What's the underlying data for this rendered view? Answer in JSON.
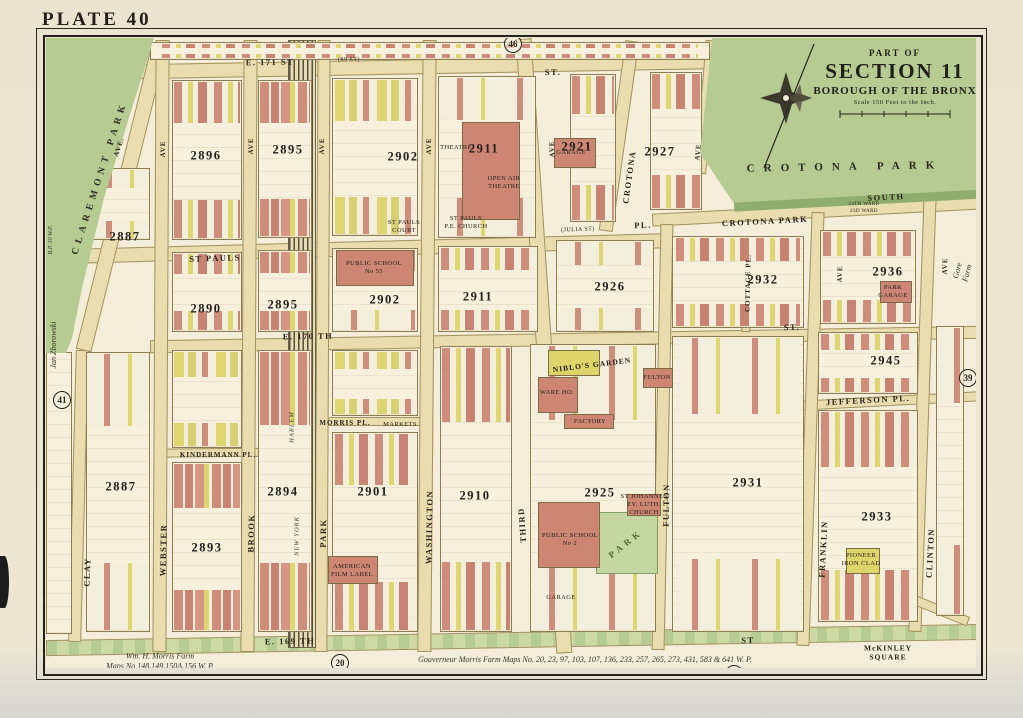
{
  "plate": "PLATE 40",
  "title_block": {
    "part_of": "PART OF",
    "section": "SECTION 11",
    "borough": "BOROUGH OF THE BRONX",
    "scale": "Scale 150 Feet to the Inch."
  },
  "colors": {
    "paper": "#e9e3cf",
    "map_bg": "#f3edda",
    "road": "#e9ddb0",
    "park_green": "#b5cb92",
    "park_edge": "#8fae6e",
    "building_pink": "#cd8574",
    "building_yellow": "#ddd46a",
    "railroad": "#57503c",
    "ink": "#25211a"
  },
  "map": {
    "roads": [
      {
        "id": "e-171-st",
        "x": 46,
        "y": 60,
        "w": 668,
        "h": 15,
        "rot": -1
      },
      {
        "id": "st-pauls-pl",
        "x": 76,
        "y": 241,
        "w": 588,
        "h": 15,
        "rot": -1.5
      },
      {
        "id": "crotona-park-south",
        "x": 652,
        "y": 205,
        "w": 332,
        "h": 13,
        "rot": -3
      },
      {
        "id": "e-170-st",
        "x": 150,
        "y": 333,
        "w": 834,
        "h": 13,
        "rot": -1
      },
      {
        "id": "kindermann-pl",
        "x": 162,
        "y": 448,
        "w": 142,
        "h": 9,
        "rot": -0.5
      },
      {
        "id": "morris-pl",
        "x": 328,
        "y": 417,
        "w": 94,
        "h": 9,
        "rot": 0
      },
      {
        "id": "jefferson-pl",
        "x": 793,
        "y": 396,
        "w": 192,
        "h": 10,
        "rot": -3
      },
      {
        "id": "e-169-st",
        "x": 46,
        "y": 632,
        "w": 938,
        "h": 16,
        "rot": -1,
        "cls": "green"
      },
      {
        "id": "claremont-pkwy",
        "x": 113,
        "y": 45,
        "w": 16,
        "h": 310,
        "rot": 14
      },
      {
        "id": "clay-ave",
        "x": 72,
        "y": 350,
        "w": 13,
        "h": 292,
        "rot": 1.5
      },
      {
        "id": "webster-ave",
        "x": 154,
        "y": 40,
        "w": 14,
        "h": 612,
        "rot": 0.3
      },
      {
        "id": "brook-ave",
        "x": 242,
        "y": 40,
        "w": 14,
        "h": 612,
        "rot": 0.3
      },
      {
        "id": "park-ave",
        "x": 316,
        "y": 40,
        "w": 13,
        "h": 612,
        "rot": 0.3
      },
      {
        "id": "washington-ave",
        "x": 420,
        "y": 40,
        "w": 14,
        "h": 612,
        "rot": 0.5
      },
      {
        "id": "third-ave",
        "x": 536,
        "y": 38,
        "w": 16,
        "h": 616,
        "rot": -3.8
      },
      {
        "id": "crotona-ave",
        "x": 612,
        "y": 40,
        "w": 14,
        "h": 192,
        "rot": 8
      },
      {
        "id": "crotona-ave-park-edge",
        "x": 700,
        "y": 40,
        "w": 12,
        "h": 134,
        "rot": 5
      },
      {
        "id": "fulton-ave",
        "x": 656,
        "y": 224,
        "w": 13,
        "h": 426,
        "rot": 1.2
      },
      {
        "id": "franklin-ave",
        "x": 804,
        "y": 212,
        "w": 13,
        "h": 434,
        "rot": 2
      },
      {
        "id": "clinton-ave",
        "x": 916,
        "y": 196,
        "w": 13,
        "h": 436,
        "rot": 2
      },
      {
        "id": "cottage-pl",
        "x": 742,
        "y": 244,
        "w": 9,
        "h": 88,
        "rot": 1
      },
      {
        "id": "mckinley-sq-diagonal",
        "x": 872,
        "y": 598,
        "w": 100,
        "h": 10,
        "rot": 22
      }
    ],
    "railroad_band": {
      "id": "ny-harlem-rr",
      "x": 288,
      "y": 40,
      "w": 28,
      "h": 608
    },
    "blocks": [
      {
        "id": "north-strip",
        "x": 150,
        "y": 42,
        "w": 560,
        "h": 18,
        "v": "v-mixed"
      },
      {
        "id": "2896-n",
        "x": 172,
        "y": 80,
        "w": 70,
        "h": 160,
        "v": "v-mixed"
      },
      {
        "id": "2895-n",
        "x": 258,
        "y": 80,
        "w": 54,
        "h": 158,
        "v": "v-dense"
      },
      {
        "id": "2902-n",
        "x": 332,
        "y": 78,
        "w": 86,
        "h": 158,
        "v": "v-yellow"
      },
      {
        "id": "2911-n",
        "x": 438,
        "y": 76,
        "w": 98,
        "h": 162,
        "v": "v-sparse"
      },
      {
        "id": "2921",
        "x": 570,
        "y": 74,
        "w": 46,
        "h": 148,
        "v": "v-mixed"
      },
      {
        "id": "2927",
        "x": 650,
        "y": 72,
        "w": 52,
        "h": 138,
        "v": "v-mixed"
      },
      {
        "id": "2890",
        "x": 172,
        "y": 252,
        "w": 70,
        "h": 80,
        "v": "v-mixed"
      },
      {
        "id": "2895-s",
        "x": 258,
        "y": 250,
        "w": 54,
        "h": 82,
        "v": "v-dense"
      },
      {
        "id": "2902-s",
        "x": 332,
        "y": 248,
        "w": 86,
        "h": 84,
        "v": "v-sparse"
      },
      {
        "id": "2911-s",
        "x": 438,
        "y": 246,
        "w": 100,
        "h": 86,
        "v": "v-mixed"
      },
      {
        "id": "2926",
        "x": 556,
        "y": 240,
        "w": 98,
        "h": 92,
        "v": "v-sparse"
      },
      {
        "id": "2932",
        "x": 672,
        "y": 236,
        "w": 132,
        "h": 92,
        "v": "v-mixed"
      },
      {
        "id": "2936",
        "x": 820,
        "y": 230,
        "w": 96,
        "h": 94,
        "v": "v-mixed"
      },
      {
        "id": "2887-upper",
        "x": 88,
        "y": 168,
        "w": 62,
        "h": 72,
        "v": "v-sparse"
      },
      {
        "id": "2887-lower",
        "x": 86,
        "y": 352,
        "w": 64,
        "h": 280,
        "v": "v-sparse"
      },
      {
        "id": "2893-n",
        "x": 172,
        "y": 350,
        "w": 70,
        "h": 98,
        "v": "v-yellow"
      },
      {
        "id": "2893-s",
        "x": 172,
        "y": 462,
        "w": 70,
        "h": 170,
        "v": "v-dense"
      },
      {
        "id": "2894",
        "x": 258,
        "y": 350,
        "w": 54,
        "h": 282,
        "v": "v-dense"
      },
      {
        "id": "2901-n",
        "x": 332,
        "y": 350,
        "w": 86,
        "h": 66,
        "v": "v-yellow"
      },
      {
        "id": "2901-s",
        "x": 332,
        "y": 432,
        "w": 86,
        "h": 200,
        "v": "v-mixed"
      },
      {
        "id": "2910",
        "x": 440,
        "y": 346,
        "w": 72,
        "h": 286,
        "v": "v-mixed"
      },
      {
        "id": "2925",
        "x": 530,
        "y": 344,
        "w": 126,
        "h": 288,
        "v": "v-sparse"
      },
      {
        "id": "2931",
        "x": 672,
        "y": 336,
        "w": 132,
        "h": 296,
        "v": "v-sparse"
      },
      {
        "id": "2945",
        "x": 818,
        "y": 332,
        "w": 100,
        "h": 62,
        "v": "v-mixed"
      },
      {
        "id": "2933",
        "x": 818,
        "y": 410,
        "w": 100,
        "h": 212,
        "v": "v-mixed"
      },
      {
        "id": "east-of-clinton",
        "x": 936,
        "y": 326,
        "w": 28,
        "h": 290,
        "v": "v-sparse"
      },
      {
        "id": "west-column",
        "x": 46,
        "y": 352,
        "w": 26,
        "h": 282,
        "v": "v-plain"
      }
    ],
    "buildings": [
      {
        "id": "theatre-building",
        "x": 462,
        "y": 122,
        "w": 58,
        "h": 98,
        "c": "p"
      },
      {
        "id": "garage-2921",
        "x": 554,
        "y": 138,
        "w": 42,
        "h": 30,
        "c": "p"
      },
      {
        "id": "public-school-55",
        "x": 336,
        "y": 250,
        "w": 78,
        "h": 36,
        "c": "p"
      },
      {
        "id": "niblos-garden-bldg",
        "x": 548,
        "y": 350,
        "w": 52,
        "h": 26,
        "c": "y"
      },
      {
        "id": "warehouse",
        "x": 538,
        "y": 377,
        "w": 40,
        "h": 36,
        "c": "p"
      },
      {
        "id": "factory",
        "x": 564,
        "y": 414,
        "w": 50,
        "h": 15,
        "c": "p"
      },
      {
        "id": "fulton-building",
        "x": 643,
        "y": 368,
        "w": 30,
        "h": 20,
        "c": "p"
      },
      {
        "id": "st-johannes-church",
        "x": 627,
        "y": 494,
        "w": 34,
        "h": 22,
        "c": "p"
      },
      {
        "id": "public-school-2",
        "x": 538,
        "y": 502,
        "w": 62,
        "h": 66,
        "c": "p"
      },
      {
        "id": "american-film-label-bldg",
        "x": 328,
        "y": 556,
        "w": 50,
        "h": 28,
        "c": "p"
      },
      {
        "id": "park-garage-bldg",
        "x": 880,
        "y": 281,
        "w": 32,
        "h": 22,
        "c": "p"
      },
      {
        "id": "pioneer-bldg",
        "x": 846,
        "y": 548,
        "w": 34,
        "h": 26,
        "c": "y"
      }
    ],
    "minipark": {
      "id": "small-park",
      "x": 596,
      "y": 512,
      "w": 62,
      "h": 62
    },
    "park_labels": [
      {
        "t": "CROTONA PARK",
        "x": 845,
        "y": 167,
        "rot": -1,
        "fs": 11,
        "ls": 9
      },
      {
        "t": "CLAREMONT PARK",
        "x": 100,
        "y": 178,
        "rot": -72,
        "fs": 9.5,
        "ls": 5
      }
    ],
    "street_labels": [
      {
        "t": "E. 171 ST",
        "x": 270,
        "y": 62,
        "rot": -1
      },
      {
        "t": "(89 ST)",
        "x": 349,
        "y": 60,
        "rot": -1,
        "cls": "tiny"
      },
      {
        "t": "ST.",
        "x": 553,
        "y": 72,
        "rot": -1
      },
      {
        "t": "ST PAULS",
        "x": 215,
        "y": 258,
        "rot": -2
      },
      {
        "t": "(JULIA ST)",
        "x": 578,
        "y": 230,
        "rot": -2,
        "cls": "tiny"
      },
      {
        "t": "PL.",
        "x": 643,
        "y": 225,
        "rot": -2
      },
      {
        "t": "CROTONA PARK",
        "x": 765,
        "y": 221,
        "rot": -3
      },
      {
        "t": "SOUTH",
        "x": 886,
        "y": 197,
        "rot": -3
      },
      {
        "t": "E. 170 TH",
        "x": 308,
        "y": 336,
        "rot": -1
      },
      {
        "t": "ST.",
        "x": 792,
        "y": 327,
        "rot": -2
      },
      {
        "t": "KINDERMANN PL.",
        "x": 218,
        "y": 455,
        "rot": 0,
        "cls": "sm"
      },
      {
        "t": "MORRIS PL.",
        "x": 345,
        "y": 423,
        "rot": 0,
        "cls": "sm"
      },
      {
        "t": "JEFFERSON PL.",
        "x": 868,
        "y": 400,
        "rot": -3
      },
      {
        "t": "E. 169 TH",
        "x": 290,
        "y": 641,
        "rot": -1
      },
      {
        "t": "ST",
        "x": 748,
        "y": 640,
        "rot": -2
      },
      {
        "t": "CLAY",
        "x": 87,
        "y": 572,
        "rot": -88
      },
      {
        "t": "WEBSTER",
        "x": 163,
        "y": 550,
        "rot": -89
      },
      {
        "t": "BROOK",
        "x": 251,
        "y": 533,
        "rot": -89
      },
      {
        "t": "PARK",
        "x": 323,
        "y": 533,
        "rot": -89
      },
      {
        "t": "WASHINGTON",
        "x": 429,
        "y": 527,
        "rot": -89
      },
      {
        "t": "THIRD",
        "x": 522,
        "y": 525,
        "rot": -94
      },
      {
        "t": "FULTON",
        "x": 666,
        "y": 505,
        "rot": -89
      },
      {
        "t": "FRANKLIN",
        "x": 823,
        "y": 549,
        "rot": -87
      },
      {
        "t": "CLINTON",
        "x": 930,
        "y": 553,
        "rot": -87
      },
      {
        "t": "CROTONA",
        "x": 629,
        "y": 177,
        "rot": -82
      },
      {
        "t": "COTTAGE PL.",
        "x": 748,
        "y": 283,
        "rot": -89,
        "cls": "sm"
      },
      {
        "t": "AVE",
        "x": 163,
        "y": 149,
        "rot": -89,
        "cls": "ave"
      },
      {
        "t": "AVE",
        "x": 251,
        "y": 146,
        "rot": -89,
        "cls": "ave"
      },
      {
        "t": "AVE",
        "x": 322,
        "y": 146,
        "rot": -89,
        "cls": "ave"
      },
      {
        "t": "AVE",
        "x": 429,
        "y": 146,
        "rot": -89,
        "cls": "ave"
      },
      {
        "t": "AVE",
        "x": 552,
        "y": 149,
        "rot": -93,
        "cls": "ave"
      },
      {
        "t": "AVE",
        "x": 698,
        "y": 152,
        "rot": -85,
        "cls": "ave"
      },
      {
        "t": "AVE",
        "x": 840,
        "y": 274,
        "rot": -88,
        "cls": "ave"
      },
      {
        "t": "AVE",
        "x": 945,
        "y": 266,
        "rot": -88,
        "cls": "ave"
      },
      {
        "t": "AVE.",
        "x": 119,
        "y": 147,
        "rot": -72,
        "cls": "ave"
      },
      {
        "t": "HARLEM",
        "x": 292,
        "y": 427,
        "rot": -90,
        "cls": "ital"
      },
      {
        "t": "NEW YORK",
        "x": 297,
        "y": 536,
        "rot": -90,
        "cls": "ital"
      }
    ],
    "block_numbers": [
      {
        "t": "2887",
        "x": 125,
        "y": 237
      },
      {
        "t": "2887",
        "x": 121,
        "y": 487
      },
      {
        "t": "2896",
        "x": 206,
        "y": 156
      },
      {
        "t": "2895",
        "x": 288,
        "y": 150
      },
      {
        "t": "2902",
        "x": 403,
        "y": 157
      },
      {
        "t": "2911",
        "x": 484,
        "y": 149
      },
      {
        "t": "2921",
        "x": 577,
        "y": 147
      },
      {
        "t": "2927",
        "x": 660,
        "y": 152
      },
      {
        "t": "2890",
        "x": 206,
        "y": 309
      },
      {
        "t": "2895",
        "x": 283,
        "y": 305
      },
      {
        "t": "2902",
        "x": 385,
        "y": 300
      },
      {
        "t": "2911",
        "x": 478,
        "y": 297
      },
      {
        "t": "2926",
        "x": 610,
        "y": 287
      },
      {
        "t": "2932",
        "x": 763,
        "y": 280
      },
      {
        "t": "2936",
        "x": 888,
        "y": 272
      },
      {
        "t": "2893",
        "x": 207,
        "y": 548
      },
      {
        "t": "2894",
        "x": 283,
        "y": 492
      },
      {
        "t": "2901",
        "x": 373,
        "y": 492
      },
      {
        "t": "2910",
        "x": 475,
        "y": 496
      },
      {
        "t": "2925",
        "x": 600,
        "y": 493
      },
      {
        "t": "2931",
        "x": 748,
        "y": 483
      },
      {
        "t": "2945",
        "x": 886,
        "y": 361
      },
      {
        "t": "2933",
        "x": 877,
        "y": 517
      }
    ],
    "feature_labels": [
      {
        "t": "PUBLIC SCHOOL\nNo 55",
        "x": 374,
        "y": 268
      },
      {
        "t": "THEATRE",
        "x": 456,
        "y": 148
      },
      {
        "t": "OPEN AIR\nTHEATRE",
        "x": 504,
        "y": 183
      },
      {
        "t": "ST PAULS\nP.E. CHURCH",
        "x": 466,
        "y": 223
      },
      {
        "t": "GARAGE",
        "x": 571,
        "y": 153
      },
      {
        "t": "ST PAULS\nCOURT",
        "x": 404,
        "y": 227
      },
      {
        "t": "NIBLO'S GARDEN",
        "x": 592,
        "y": 365,
        "rot": -7,
        "cls": "big"
      },
      {
        "t": "WARE HO.",
        "x": 557,
        "y": 393
      },
      {
        "t": "FACTORY",
        "x": 590,
        "y": 422
      },
      {
        "t": "FULTON",
        "x": 657,
        "y": 378
      },
      {
        "t": "ST JOHANNES\nEV. LUTH.\nCHURCH",
        "x": 644,
        "y": 505
      },
      {
        "t": "PUBLIC SCHOOL\nNo 2",
        "x": 570,
        "y": 540
      },
      {
        "t": "PARK",
        "x": 626,
        "y": 544,
        "rot": -38,
        "cls": "green"
      },
      {
        "t": "GARAGE",
        "x": 561,
        "y": 598
      },
      {
        "t": "AMERICAN\nFILM LABEL",
        "x": 352,
        "y": 571
      },
      {
        "t": "MARKETS",
        "x": 400,
        "y": 425
      },
      {
        "t": "PIONEER\nIRON CLAD",
        "x": 861,
        "y": 560
      },
      {
        "t": "PARK\nGARAGE",
        "x": 893,
        "y": 292
      },
      {
        "t": "24TH WARD",
        "x": 864,
        "y": 205,
        "fs": 5
      },
      {
        "t": "23D WARD",
        "x": 864,
        "y": 212,
        "fs": 5
      },
      {
        "t": "McKINLEY\nSQUARE",
        "x": 888,
        "y": 653,
        "cls": "big"
      }
    ],
    "margin_notes": [
      {
        "t": "Jan Zborowski",
        "x": 54,
        "y": 345,
        "rot": -90
      },
      {
        "t": "B.P. 30 W.P.",
        "x": 52,
        "y": 240,
        "rot": -90,
        "cls": "tiny"
      },
      {
        "t": "Gore Farm",
        "x": 963,
        "y": 272,
        "rot": -75
      },
      {
        "t": "Wm. H. Morris Farm\nMaps No 148,149,150A,156 W. P.",
        "x": 160,
        "y": 662,
        "rot": 0
      },
      {
        "t": "Gouverneur Morris Farm Maps No. 20, 23, 97, 103, 107, 136, 233, 257, 265, 273, 431, 583 & 641 W. P.",
        "x": 585,
        "y": 660,
        "rot": 0
      }
    ],
    "margin_circles": [
      {
        "t": "46",
        "x": 513,
        "y": 44
      },
      {
        "t": "41",
        "x": 62,
        "y": 400
      },
      {
        "t": "39",
        "x": 968,
        "y": 378
      },
      {
        "t": "20",
        "x": 340,
        "y": 663
      },
      {
        "t": "21",
        "x": 734,
        "y": 674
      }
    ]
  }
}
